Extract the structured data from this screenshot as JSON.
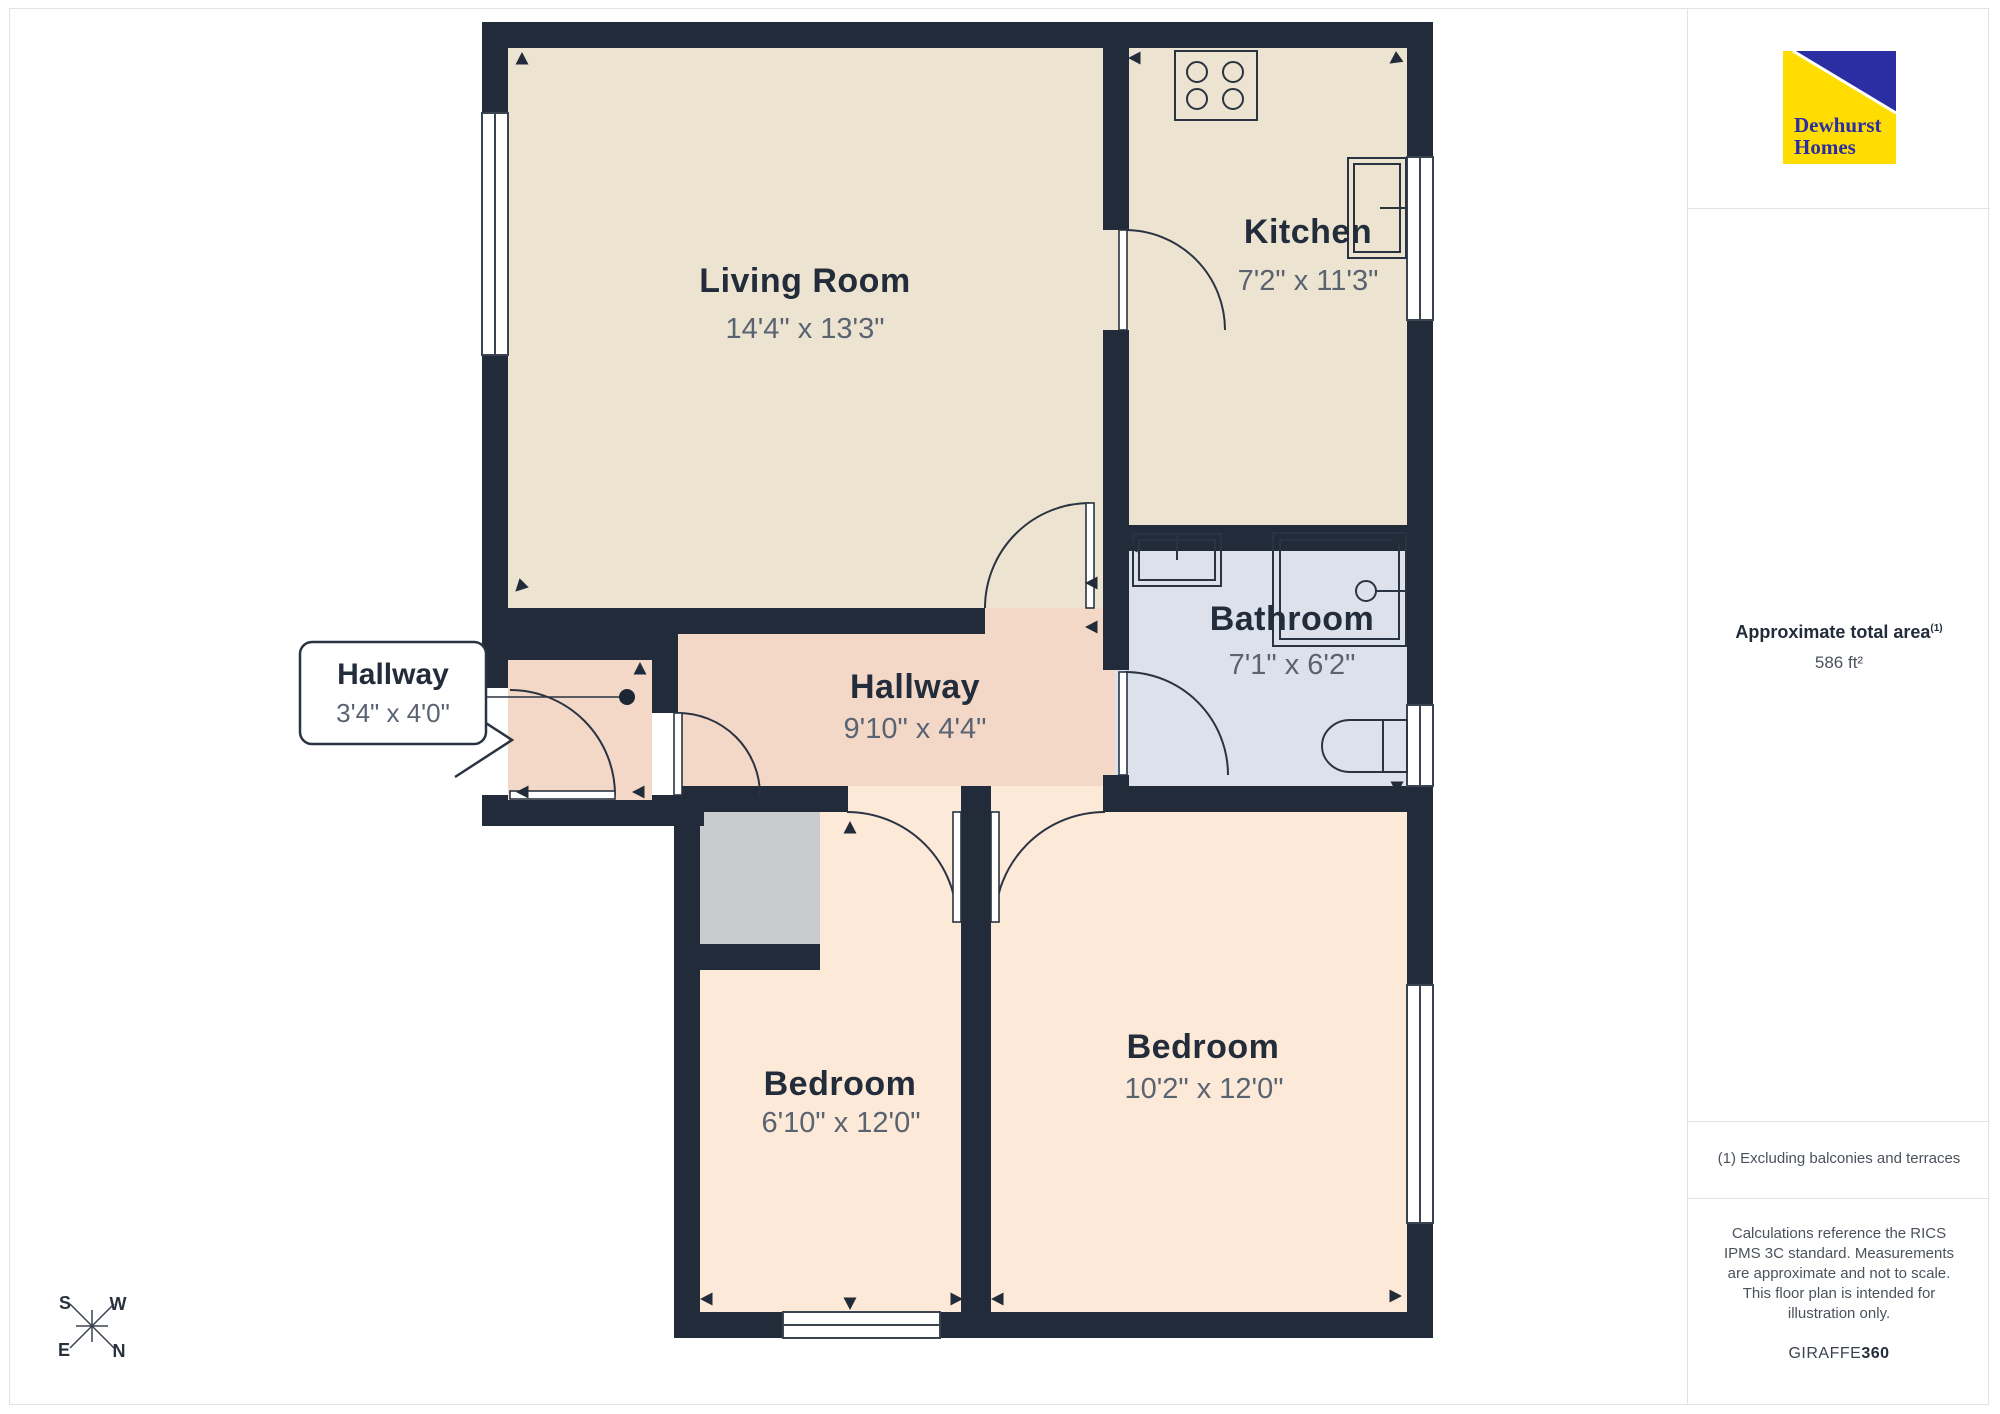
{
  "brand": {
    "line1": "Dewhurst",
    "line2": "Homes"
  },
  "sidebar": {
    "area_label": "Approximate total area",
    "area_sup": "(1)",
    "area_value": "586 ft²",
    "footnote": "(1) Excluding balconies and terraces",
    "disclaimer": "Calculations reference the RICS IPMS 3C standard. Measurements are approximate and not to scale. This floor plan is intended for illustration only.",
    "credit_normal": "GIRAFFE",
    "credit_bold": "360"
  },
  "rooms": [
    {
      "name": "Living Room",
      "dimensions": "14'4\" x 13'3\"",
      "floor_color": "#ece4d0"
    },
    {
      "name": "Kitchen",
      "dimensions": "7'2\" x 11'3\"",
      "floor_color": "#ece4d0"
    },
    {
      "name": "Bathroom",
      "dimensions": "7'1\" x 6'2\"",
      "floor_color": "#dde1ec"
    },
    {
      "name": "Hallway",
      "dimensions": "9'10\" x 4'4\"",
      "floor_color": "#f3d8c8"
    },
    {
      "name": "Hallway",
      "dimensions": "3'4\" x 4'0\"",
      "floor_color": "#f3d8c8"
    },
    {
      "name": "Bedroom",
      "dimensions": "6'10\" x 12'0\"",
      "floor_color": "#fce9d7"
    },
    {
      "name": "Bedroom",
      "dimensions": "10'2\" x 12'0\"",
      "floor_color": "#fce9d7"
    }
  ],
  "compass": {
    "s": "S",
    "w": "W",
    "e": "E",
    "n": "N"
  },
  "colors": {
    "wall": "#222b39",
    "line": "#2a3342",
    "storage": "#c9cccf",
    "logo_yellow": "#ffdd00",
    "logo_blue": "#2b2ea3",
    "divider": "#dfe3e7"
  }
}
